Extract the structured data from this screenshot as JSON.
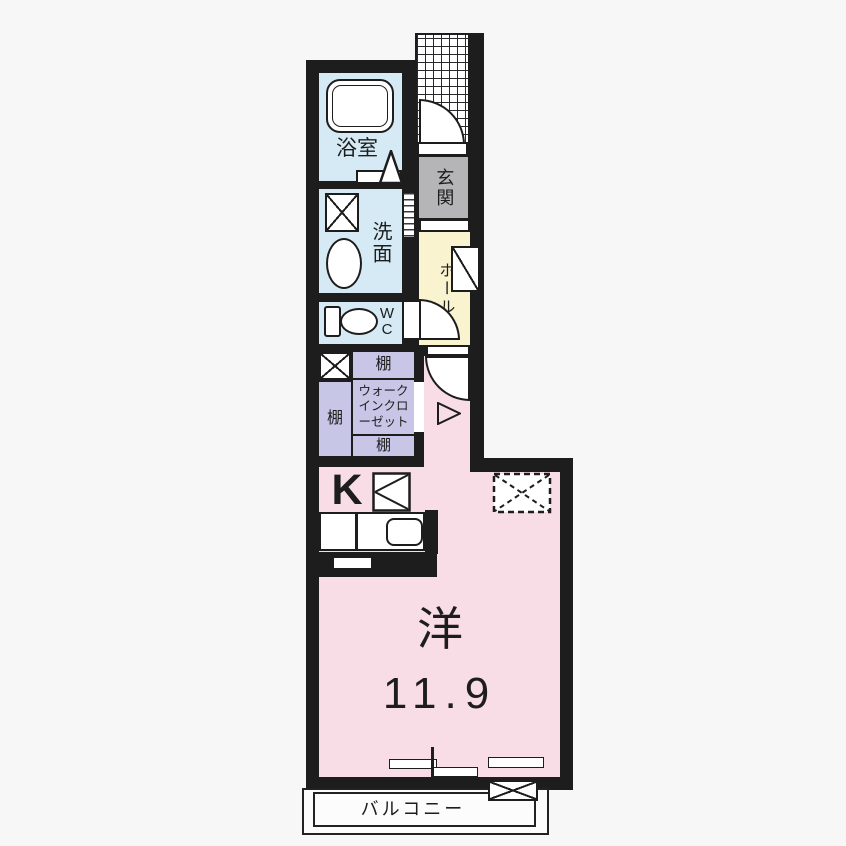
{
  "floorplan": {
    "rooms": {
      "bathroom": {
        "label": "浴室"
      },
      "washroom": {
        "label": "洗面"
      },
      "toilet": {
        "label": "WC",
        "letters": [
          "W",
          "C"
        ]
      },
      "entrance": {
        "label": "玄関"
      },
      "hall": {
        "label": "ホール"
      },
      "walk_in_closet": {
        "label": "ウォークインクローゼット",
        "line1": "ウォーク",
        "line2": "インクロ",
        "line3": "ーゼット"
      },
      "shelf_top": {
        "label": "棚"
      },
      "shelf_left": {
        "label": "棚"
      },
      "shelf_bottom": {
        "label": "棚"
      },
      "kitchen": {
        "label": "K"
      },
      "western_room": {
        "label": "洋",
        "area_tatami": "11.9"
      },
      "balcony": {
        "label": "バルコニー"
      }
    },
    "colors": {
      "wall": "#1d1d1d",
      "wet_area_floor": "#d5eaf4",
      "entrance_floor": "#b5b5b7",
      "hall_floor": "#f9f3cf",
      "closet_floor": "#c8c6e7",
      "room_floor": "#f8dce6",
      "background": "#f7f7f8"
    }
  }
}
